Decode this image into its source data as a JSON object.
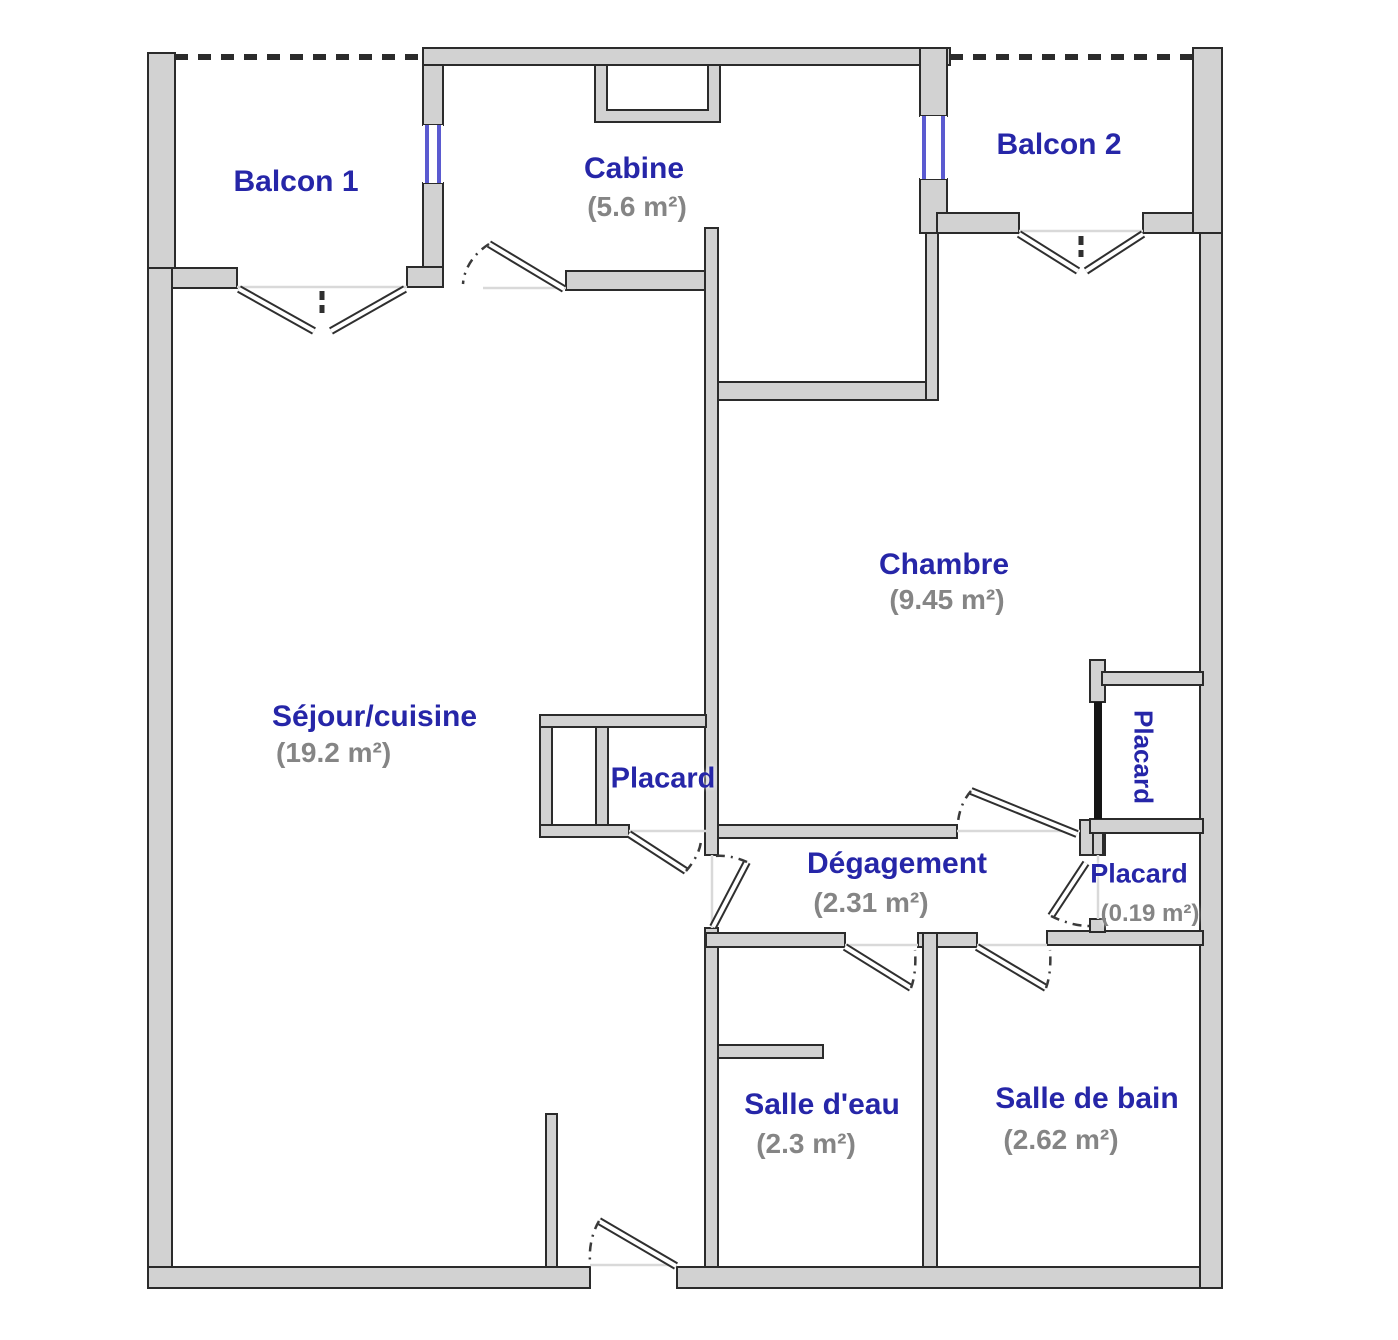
{
  "colors": {
    "label_blue": "#2626a8",
    "area_gray": "#858585",
    "wall_fill": "#d2d2d2",
    "wall_stroke": "#2b2b2b",
    "window_blue": "#5a5ad0",
    "door_black": "#151515",
    "threshold": "#d9d9d9"
  },
  "plan": {
    "rooms": [
      {
        "name": "balcon-1",
        "label": "Balcon 1",
        "area": null
      },
      {
        "name": "cabine",
        "label": "Cabine",
        "area": "(5.6 m²)"
      },
      {
        "name": "balcon-2",
        "label": "Balcon 2",
        "area": null
      },
      {
        "name": "chambre",
        "label": "Chambre",
        "area": "(9.45 m²)"
      },
      {
        "name": "sejour-cuisine",
        "label": "Séjour/cuisine",
        "area": "(19.2 m²)"
      },
      {
        "name": "placard-sejour",
        "label": "Placard",
        "area": null
      },
      {
        "name": "degagement",
        "label": "Dégagement",
        "area": "(2.31 m²)"
      },
      {
        "name": "placard-chambre",
        "label": "Placard",
        "area": null
      },
      {
        "name": "placard-couloir",
        "label": "Placard",
        "area": "(0.19 m²)"
      },
      {
        "name": "salle-d-eau",
        "label": "Salle d'eau",
        "area": "(2.3 m²)"
      },
      {
        "name": "salle-de-bain",
        "label": "Salle de bain",
        "area": "(2.62 m²)"
      }
    ]
  }
}
